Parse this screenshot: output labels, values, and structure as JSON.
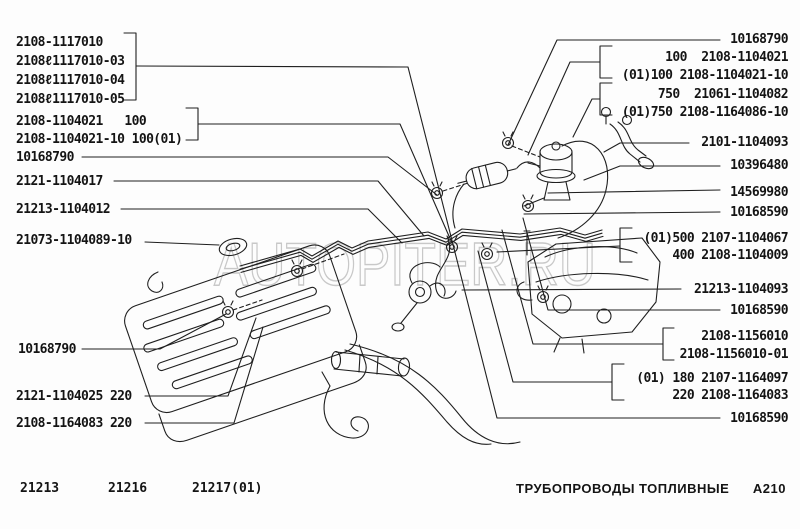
{
  "page_title": "ТРУБОПРОВОДЫ ТОПЛИВНЫЕ",
  "drawing_code": "A210",
  "watermark": "AUTOPITER.RU",
  "models": [
    "21213",
    "21216",
    "21217(01)"
  ],
  "labels": {
    "left": [
      "2108-1117010",
      "2108ℓ1117010-03",
      "2108ℓ1117010-04",
      "2108ℓ1117010-05",
      "2108-1104021   100",
      "2108-1104021-10 100(01)",
      "10168790",
      "2121-1104017",
      "21213-1104012",
      "21073-1104089-10",
      "10168790",
      "2121-1104025 220",
      "2108-1164083 220"
    ],
    "right": [
      "10168790",
      "100  2108-1104021",
      "(01)100 2108-1104021-10",
      "750  21061-1104082",
      "(01)750 2108-1164086-10",
      "2101-1104093",
      "10396480",
      "14569980",
      "10168590",
      "(01)500 2107-1104067",
      "400 2108-1104009",
      "21213-1104093",
      "10168590",
      "2108-1156010",
      "2108-1156010-01",
      "(01) 180 2107-1164097",
      "220 2108-1164083",
      "10168590"
    ]
  },
  "colors": {
    "line": "#1f1f1f",
    "watermark": "#c8c8c8",
    "bg": "#fdfdfd",
    "text": "#141414"
  }
}
